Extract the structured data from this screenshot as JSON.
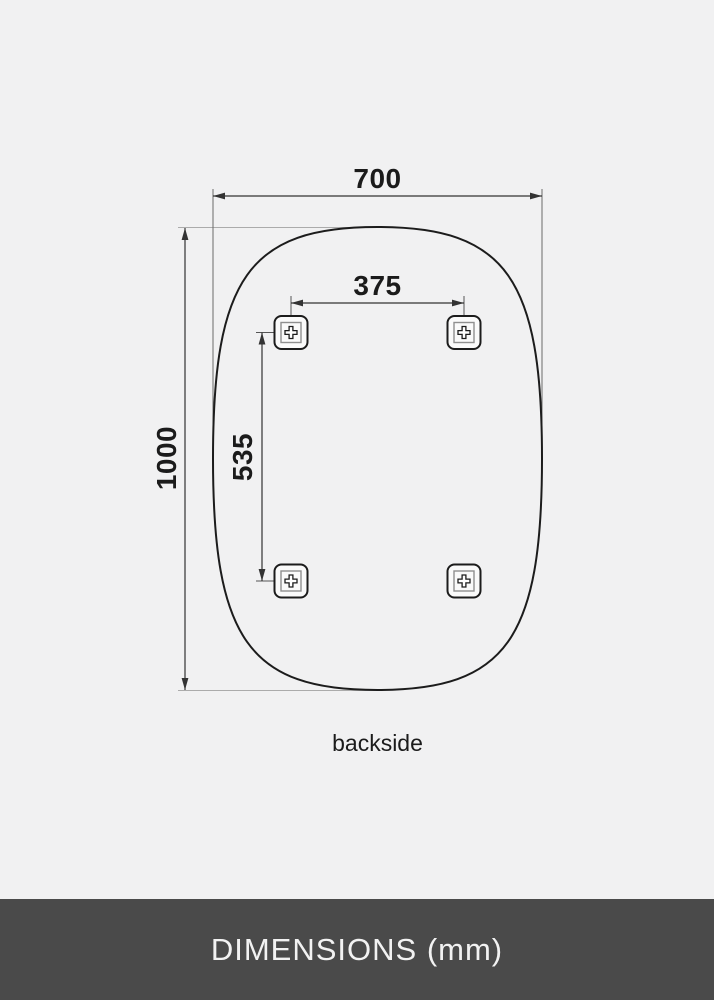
{
  "page": {
    "background_color": "#f1f1f2"
  },
  "diagram": {
    "view_label": "backside",
    "outline_color": "#1c1c1c",
    "dimension_line_color": "#333333",
    "extension_line_color": "#aaaaaa",
    "dimensions": {
      "width": "700",
      "height": "1000",
      "mount_spacing_horizontal": "375",
      "mount_spacing_vertical": "535"
    },
    "mount_bracket": {
      "icon": "screw-plus-icon",
      "count": 4
    }
  },
  "footer": {
    "label": "DIMENSIONS (mm)",
    "background_color": "#4a4a4a",
    "text_color": "#f2f2f2"
  }
}
